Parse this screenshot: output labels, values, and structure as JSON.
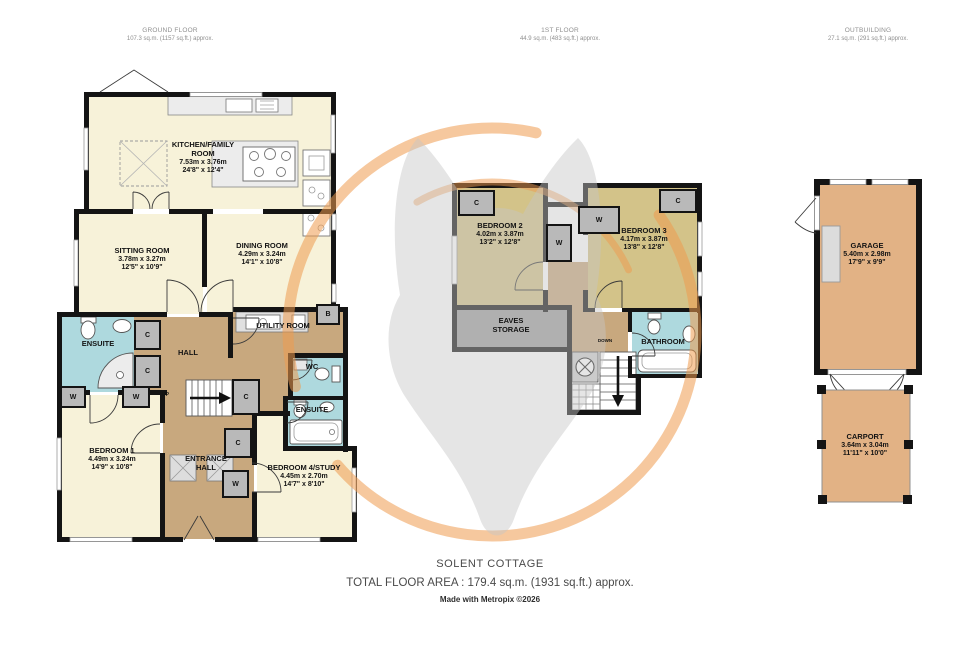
{
  "headers": {
    "ground": {
      "title": "GROUND FLOOR",
      "area": "107.3 sq.m. (1157 sq.ft.) approx."
    },
    "first": {
      "title": "1ST FLOOR",
      "area": "44.9 sq.m. (483 sq.ft.) approx."
    },
    "outbuilding": {
      "title": "OUTBUILDING",
      "area": "27.1 sq.m. (291 sq.ft.) approx."
    }
  },
  "rooms": {
    "kitchen": {
      "name": "KITCHEN/FAMILY ROOM",
      "metric": "7.53m x 3.76m",
      "imperial": "24'8\" x 12'4\""
    },
    "sitting": {
      "name": "SITTING ROOM",
      "metric": "3.78m x 3.27m",
      "imperial": "12'5\" x 10'9\""
    },
    "dining": {
      "name": "DINING ROOM",
      "metric": "4.29m x 3.24m",
      "imperial": "14'1\" x 10'8\""
    },
    "ensuite1": {
      "name": "ENSUITE"
    },
    "hall": {
      "name": "HALL"
    },
    "utility": {
      "name": "UTILITY ROOM"
    },
    "wc": {
      "name": "WC"
    },
    "bedroom1": {
      "name": "BEDROOM 1",
      "metric": "4.49m x 3.24m",
      "imperial": "14'9\" x 10'8\""
    },
    "entrance": {
      "name": "ENTRANCE HALL"
    },
    "bedroom4": {
      "name": "BEDROOM 4/STUDY",
      "metric": "4.45m x 2.70m",
      "imperial": "14'7\" x 8'10\""
    },
    "ensuite2": {
      "name": "ENSUITE"
    },
    "bedroom2": {
      "name": "BEDROOM 2",
      "metric": "4.02m x 3.87m",
      "imperial": "13'2\" x 12'8\""
    },
    "bedroom3": {
      "name": "BEDROOM 3",
      "metric": "4.17m x 3.87m",
      "imperial": "13'8\" x 12'8\""
    },
    "eaves": {
      "name": "EAVES STORAGE"
    },
    "bathroom": {
      "name": "BATHROOM"
    },
    "garage": {
      "name": "GARAGE",
      "metric": "5.40m x 2.98m",
      "imperial": "17'9\" x 9'9\""
    },
    "carport": {
      "name": "CARPORT",
      "metric": "3.64m x 3.04m",
      "imperial": "11'11\" x 10'0\""
    }
  },
  "marks": {
    "up": "UP",
    "down": "DOWN",
    "w": "W",
    "c": "C",
    "b": "B"
  },
  "footer": {
    "property_name": "SOLENT COTTAGE",
    "total_area": "TOTAL FLOOR AREA : 179.4 sq.m. (1931 sq.ft.) approx.",
    "credit": "Made with Metropix ©2026"
  },
  "colors": {
    "wall": "#141414",
    "room_cream": "#f7f2d9",
    "room_khaki": "#d3c389",
    "hall_tan": "#c8a87e",
    "bath_blue": "#aed9de",
    "storage_gray": "#9f9f9f",
    "cupboard_gray": "#b9b9b9",
    "outbuilding_tan": "#e2b285",
    "watermark_orange": "#ef9a4e",
    "watermark_gray": "#c6c6c6"
  }
}
